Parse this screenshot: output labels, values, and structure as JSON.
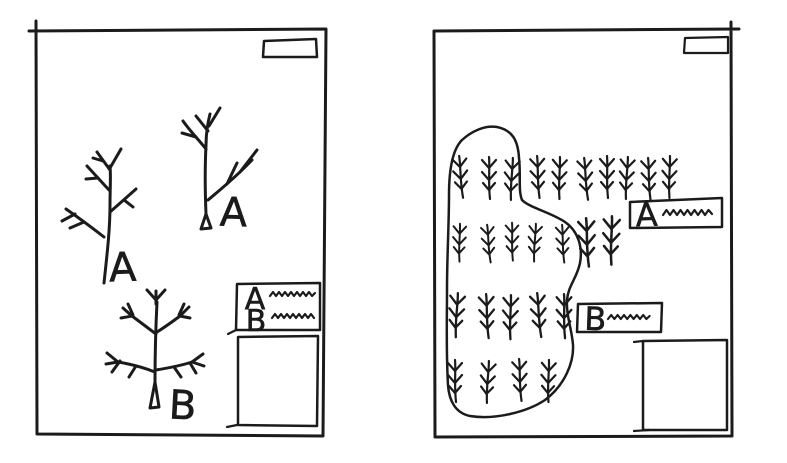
{
  "canvas": {
    "background_color": "#ffffff",
    "ink_color": "#1b1b1b"
  },
  "left_panel": {
    "tree_a1_label": "A",
    "tree_a2_label": "A",
    "tree_b_label": "B",
    "legend": {
      "row_a_label": "A",
      "row_b_label": "B"
    }
  },
  "right_panel": {
    "label_a": "A",
    "label_b": "B",
    "sprig_rows": [
      {
        "y": 155,
        "scale": 1.0,
        "xs": [
          459,
          489,
          513,
          537,
          560,
          584,
          607,
          628,
          648,
          670
        ]
      },
      {
        "y": 222,
        "scale": 0.9,
        "xs": [
          460,
          487,
          512,
          536,
          562
        ]
      },
      {
        "y": 215,
        "scale": 1.15,
        "xs": [
          586,
          612
        ]
      },
      {
        "y": 292,
        "scale": 1.05,
        "xs": [
          458,
          486,
          511,
          537,
          564
        ]
      },
      {
        "y": 358,
        "scale": 1.0,
        "xs": [
          455,
          489,
          519,
          549
        ]
      }
    ]
  }
}
